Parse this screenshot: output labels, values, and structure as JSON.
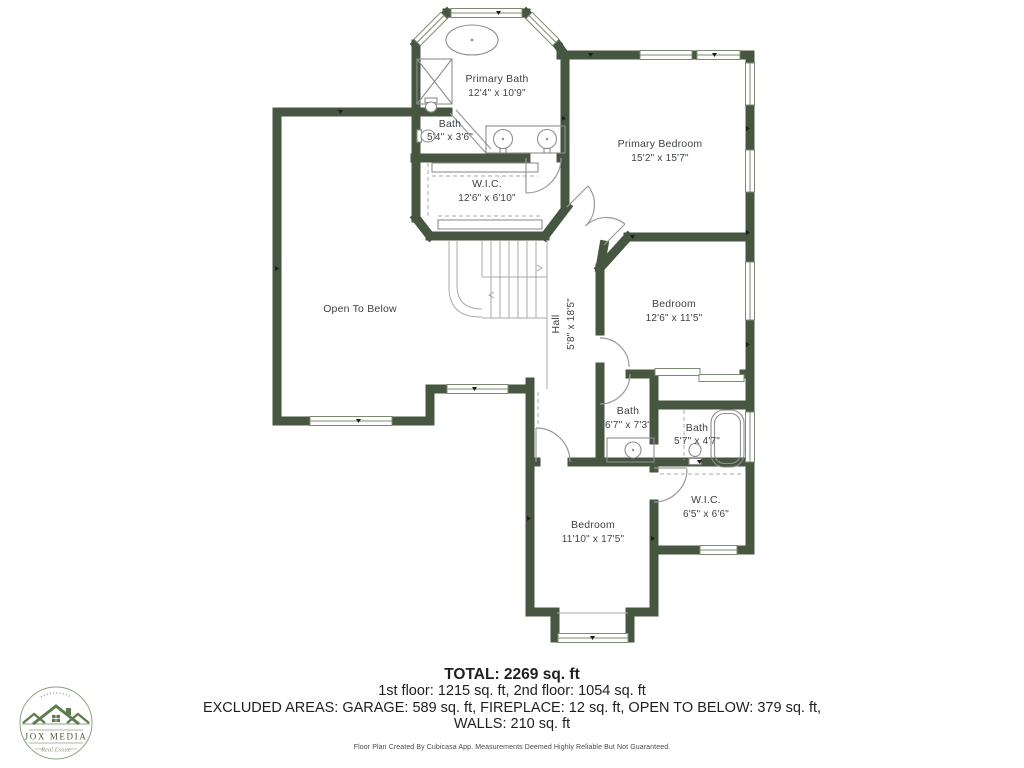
{
  "plan": {
    "rooms": [
      {
        "id": "primary-bath",
        "name": "Primary Bath",
        "dims": "12'4\" x 10'9\""
      },
      {
        "id": "bath-primary-small",
        "name": "Bath",
        "dims": "5'4\" x 3'6\""
      },
      {
        "id": "primary-bedroom",
        "name": "Primary Bedroom",
        "dims": "15'2\" x 15'7\""
      },
      {
        "id": "wic-primary",
        "name": "W.I.C.",
        "dims": "12'6\" x 6'10\""
      },
      {
        "id": "open-to-below",
        "name": "Open To Below",
        "dims": ""
      },
      {
        "id": "hall",
        "name": "Hall",
        "dims": "5'8\" x 18'5\""
      },
      {
        "id": "bedroom-2",
        "name": "Bedroom",
        "dims": "12'6\" x 11'5\""
      },
      {
        "id": "bath-hall",
        "name": "Bath",
        "dims": "6'7\" x 7'3\""
      },
      {
        "id": "bath-2",
        "name": "Bath",
        "dims": "5'7\" x 4'7\""
      },
      {
        "id": "wic-2",
        "name": "W.I.C.",
        "dims": "6'5\" x 6'6\""
      },
      {
        "id": "bedroom-3",
        "name": "Bedroom",
        "dims": "11'10\" x 17'5\""
      }
    ]
  },
  "summary": {
    "total": "TOTAL: 2269 sq. ft",
    "floors": "1st floor: 1215 sq. ft, 2nd floor: 1054 sq. ft",
    "excluded": "EXCLUDED AREAS: GARAGE: 589 sq. ft, FIREPLACE: 12 sq. ft, OPEN TO BELOW: 379 sq. ft,",
    "walls": "WALLS: 210 sq. ft",
    "disclaimer": "Floor Plan Created By Cubicasa App. Measurements Deemed Highly Reliable But Not Guaranteed."
  },
  "logo": {
    "name": "JOX MEDIA",
    "tagline": "Real Estate"
  },
  "colors": {
    "wall": "#475640",
    "label": "#3e4347",
    "winline": "#7c8a72",
    "logo_green": "#5e7b50",
    "logo_soft": "#8aa07c",
    "logo_text": "#4c5b44"
  }
}
